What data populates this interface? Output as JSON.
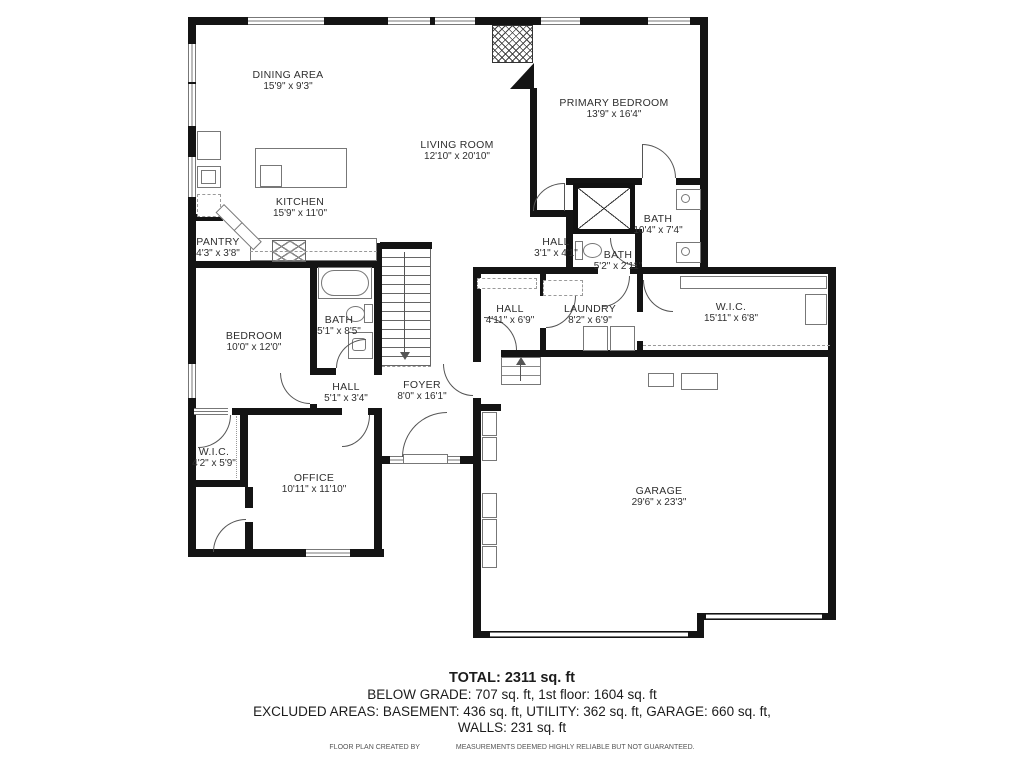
{
  "rooms": [
    {
      "name": "DINING AREA",
      "dims": "15'9\" x 9'3\""
    },
    {
      "name": "LIVING ROOM",
      "dims": "12'10\" x 20'10\""
    },
    {
      "name": "PRIMARY BEDROOM",
      "dims": "13'9\" x 16'4\""
    },
    {
      "name": "KITCHEN",
      "dims": "15'9\" x 11'0\""
    },
    {
      "name": "PANTRY",
      "dims": "4'3\" x 3'8\""
    },
    {
      "name": "HALL",
      "dims": "3'1\" x 4'1\""
    },
    {
      "name": "BATH",
      "dims": "10'4\" x 7'4\""
    },
    {
      "name": "BATH",
      "dims": "5'2\" x 2'11\""
    },
    {
      "name": "HALL",
      "dims": "4'11\" x 6'9\""
    },
    {
      "name": "LAUNDRY",
      "dims": "8'2\" x 6'9\""
    },
    {
      "name": "W.I.C.",
      "dims": "15'11\" x 6'8\""
    },
    {
      "name": "BEDROOM",
      "dims": "10'0\" x 12'0\""
    },
    {
      "name": "BATH",
      "dims": "5'1\" x 8'5\""
    },
    {
      "name": "HALL",
      "dims": "5'1\" x 3'4\""
    },
    {
      "name": "FOYER",
      "dims": "8'0\" x 16'1\""
    },
    {
      "name": "W.I.C.",
      "dims": "4'2\" x 5'9\""
    },
    {
      "name": "OFFICE",
      "dims": "10'11\" x 11'10\""
    },
    {
      "name": "GARAGE",
      "dims": "29'6\" x 23'3\""
    }
  ],
  "footer": {
    "total": "TOTAL: 2311 sq. ft",
    "line2": "BELOW GRADE: 707 sq. ft, 1st floor: 1604 sq. ft",
    "line3": "EXCLUDED AREAS: BASEMENT: 436 sq. ft, UTILITY: 362 sq. ft, GARAGE: 660 sq. ft,",
    "line4": "WALLS: 231 sq. ft",
    "credit": "FLOOR PLAN CREATED BY",
    "disclaimer": "MEASUREMENTS DEEMED HIGHLY RELIABLE BUT NOT GUARANTEED."
  }
}
